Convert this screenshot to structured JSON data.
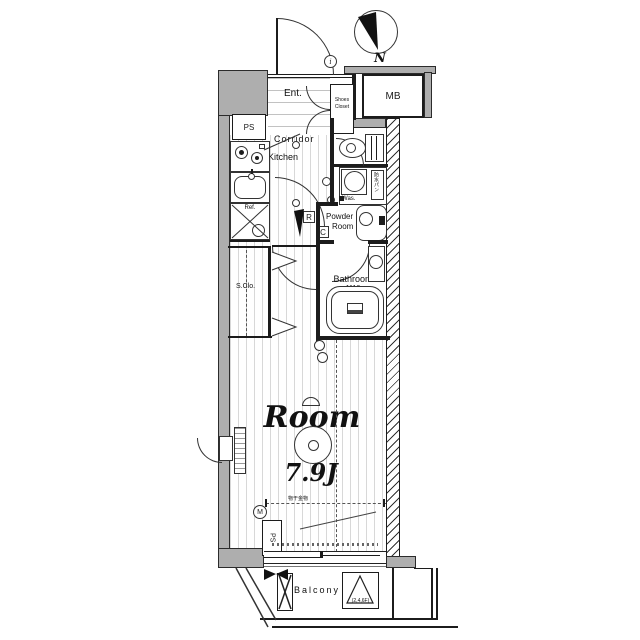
{
  "plan": {
    "compass": {
      "north_label": "N"
    },
    "labels": {
      "entrance": "Ent.",
      "shoes_closet_line1": "Shoes",
      "shoes_closet_line2": "Closet",
      "doorbell": "i",
      "meter_box": "MB",
      "pipe_space_top": "PS",
      "pipe_space_bottom": "PS",
      "corridor": "Corridor",
      "kitchen": "Kitchen",
      "refrigerator": "Ref.",
      "washer": "Was.",
      "washer_pan": "防水パン",
      "powder_line1": "Powder",
      "powder_line2": "Room",
      "bathroom": "Bathroom",
      "bathroom_size": "1116",
      "storage_closet": "S.Clo.",
      "room": "Room",
      "room_size": "7.9J",
      "laundry_fitting": "物干金物",
      "balcony": "Balcony",
      "hatch_floors": "(2,4,6F)",
      "range_mark": "R",
      "controller_mark": "C",
      "meter_mark": "M"
    },
    "colors": {
      "wall_gray": "#aeaeae",
      "line": "#1c1c1c",
      "floor_stripe": "#d8d8d8"
    }
  }
}
